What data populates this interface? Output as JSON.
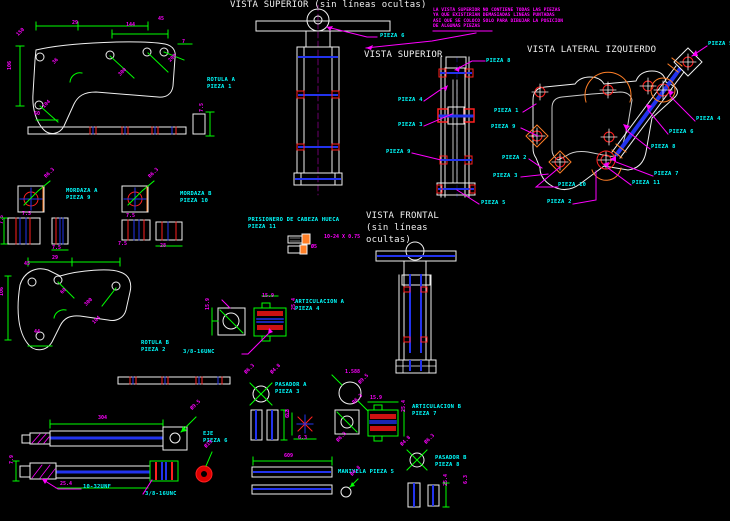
{
  "app": {
    "type": "cad-drawing-canvas",
    "background": "#000000"
  },
  "colors": {
    "white": "#f0f0f0",
    "green": "#00ff00",
    "magenta": "#ff00ff",
    "cyan": "#00ffff",
    "red": "#ff2020",
    "blue": "#2233ee",
    "orange": "#ff7f27"
  },
  "titles": [
    {
      "text": "VISTA SUPERIOR (sin líneas ocultas)",
      "x": 230,
      "y": 1
    },
    {
      "text": "VISTA SUPERIOR",
      "x": 364,
      "y": 51
    },
    {
      "text": "VISTA LATERAL IZQUIERDO",
      "x": 527,
      "y": 46
    },
    {
      "text": "VISTA FRONTAL",
      "x": 366,
      "y": 212
    },
    {
      "text": "(sin líneas",
      "x": 366,
      "y": 224
    },
    {
      "text": "ocultas)",
      "x": 366,
      "y": 236
    }
  ],
  "note": {
    "x": 433,
    "y": 9,
    "lines": [
      "LA VISTA SUPERIOR NO CONTIENE TODAS LAS PIEZAS",
      "YA QUE EXISTIRIAN DEMASIADAS LINEAS PUNTADAS",
      "ASI QUE SE COLOCO SOLO PARA DIBUJAR LA POSICION",
      "DE ALGUNAS PIEZAS"
    ]
  },
  "part_labels": [
    {
      "text": "PIEZA 6",
      "x": 380,
      "y": 34
    },
    {
      "text": "PIEZA 8",
      "x": 486,
      "y": 59
    },
    {
      "text": "PIEZA 4",
      "x": 398,
      "y": 98
    },
    {
      "text": "PIEZA 3",
      "x": 398,
      "y": 123
    },
    {
      "text": "PIEZA 9",
      "x": 386,
      "y": 150
    },
    {
      "text": "PIEZA 5",
      "x": 481,
      "y": 201
    },
    {
      "text": "PIEZA 1",
      "x": 494,
      "y": 109
    },
    {
      "text": "PIEZA 9",
      "x": 491,
      "y": 125
    },
    {
      "text": "PIEZA 2",
      "x": 502,
      "y": 156
    },
    {
      "text": "PIEZA 3",
      "x": 493,
      "y": 174
    },
    {
      "text": "PIEZA 5",
      "x": 708,
      "y": 42
    },
    {
      "text": "PIEZA 4",
      "x": 696,
      "y": 117
    },
    {
      "text": "PIEZA 6",
      "x": 669,
      "y": 130
    },
    {
      "text": "PIEZA 8",
      "x": 651,
      "y": 145
    },
    {
      "text": "PIEZA 7",
      "x": 654,
      "y": 172
    },
    {
      "text": "PIEZA 11",
      "x": 632,
      "y": 181
    },
    {
      "text": "PIEZA 10",
      "x": 558,
      "y": 183
    },
    {
      "text": "PIEZA 2",
      "x": 547,
      "y": 200
    },
    {
      "text": "ROTULA A",
      "x": 207,
      "y": 78
    },
    {
      "text": "PIEZA 1",
      "x": 207,
      "y": 85
    },
    {
      "text": "MORDAZA A",
      "x": 66,
      "y": 189
    },
    {
      "text": "PIEZA 9",
      "x": 66,
      "y": 196
    },
    {
      "text": "MORDAZA B",
      "x": 180,
      "y": 192
    },
    {
      "text": "PIEZA 10",
      "x": 180,
      "y": 199
    },
    {
      "text": "PRISIONERO DE CABEZA HUECA",
      "x": 248,
      "y": 218
    },
    {
      "text": "PIEZA 11",
      "x": 248,
      "y": 225
    },
    {
      "text": "ARTICULACION A",
      "x": 295,
      "y": 300
    },
    {
      "text": "PIEZA 4",
      "x": 295,
      "y": 307
    },
    {
      "text": "ROTULA B",
      "x": 141,
      "y": 341
    },
    {
      "text": "PIEZA 2",
      "x": 141,
      "y": 348
    },
    {
      "text": "3/8-16UNC",
      "x": 183,
      "y": 350
    },
    {
      "text": "EJE",
      "x": 203,
      "y": 432
    },
    {
      "text": "PIEZA 6",
      "x": 203,
      "y": 439
    },
    {
      "text": "10-32UNF",
      "x": 83,
      "y": 485
    },
    {
      "text": "3/8-16UNC",
      "x": 145,
      "y": 492
    },
    {
      "text": "PASADOR A",
      "x": 275,
      "y": 383
    },
    {
      "text": "PIEZA 3",
      "x": 275,
      "y": 390
    },
    {
      "text": "ARTICULACION B",
      "x": 412,
      "y": 405
    },
    {
      "text": "PIEZA 7",
      "x": 412,
      "y": 412
    },
    {
      "text": "MANIVELA PIEZA 5",
      "x": 338,
      "y": 470
    },
    {
      "text": "PASADOR B",
      "x": 435,
      "y": 456
    },
    {
      "text": "PIEZA 8",
      "x": 435,
      "y": 463
    }
  ],
  "dim_labels": [
    {
      "text": "29",
      "x": 72,
      "y": 21
    },
    {
      "text": "144",
      "x": 126,
      "y": 23
    },
    {
      "text": "45",
      "x": 158,
      "y": 17
    },
    {
      "text": "150",
      "x": 16,
      "y": 34,
      "rot": -45
    },
    {
      "text": "7",
      "x": 182,
      "y": 40
    },
    {
      "text": "36",
      "x": 52,
      "y": 62,
      "rot": -45
    },
    {
      "text": "200",
      "x": 168,
      "y": 60,
      "rot": -45
    },
    {
      "text": "106",
      "x": 8,
      "y": 70,
      "rot": -90
    },
    {
      "text": "300",
      "x": 118,
      "y": 74,
      "rot": -45
    },
    {
      "text": "104",
      "x": 42,
      "y": 106,
      "rot": -45
    },
    {
      "text": "60",
      "x": 34,
      "y": 112
    },
    {
      "text": "7.5",
      "x": 200,
      "y": 112,
      "rot": -90
    },
    {
      "text": "R6.3",
      "x": 44,
      "y": 176,
      "rot": -45
    },
    {
      "text": "7.5",
      "x": 22,
      "y": 212
    },
    {
      "text": "7.5",
      "x": 0,
      "y": 224,
      "rot": -90
    },
    {
      "text": "7.5",
      "x": 52,
      "y": 246
    },
    {
      "text": "R6.3",
      "x": 148,
      "y": 176,
      "rot": -45
    },
    {
      "text": "7.5",
      "x": 126,
      "y": 214
    },
    {
      "text": "7.5",
      "x": 118,
      "y": 242
    },
    {
      "text": "28",
      "x": 160,
      "y": 244
    },
    {
      "text": "10-24 X 0.75",
      "x": 324,
      "y": 235
    },
    {
      "text": "Ø5",
      "x": 311,
      "y": 245
    },
    {
      "text": "15.9",
      "x": 206,
      "y": 310,
      "rot": -90
    },
    {
      "text": "15.9",
      "x": 262,
      "y": 294
    },
    {
      "text": "25.4",
      "x": 292,
      "y": 310,
      "rot": -90
    },
    {
      "text": "29",
      "x": 52,
      "y": 256
    },
    {
      "text": "45",
      "x": 24,
      "y": 262
    },
    {
      "text": "106",
      "x": 0,
      "y": 296,
      "rot": -90
    },
    {
      "text": "60",
      "x": 60,
      "y": 292,
      "rot": -45
    },
    {
      "text": "300",
      "x": 84,
      "y": 304,
      "rot": -45
    },
    {
      "text": "104",
      "x": 92,
      "y": 322,
      "rot": -45
    },
    {
      "text": "44",
      "x": 34,
      "y": 330
    },
    {
      "text": "304",
      "x": 98,
      "y": 416
    },
    {
      "text": "Ø9.5",
      "x": 190,
      "y": 408,
      "rot": -45
    },
    {
      "text": "Ø19",
      "x": 204,
      "y": 446,
      "rot": -45
    },
    {
      "text": "7.9",
      "x": 10,
      "y": 464,
      "rot": -90
    },
    {
      "text": "25.4",
      "x": 60,
      "y": 482
    },
    {
      "text": "Ø6.3",
      "x": 244,
      "y": 372,
      "rot": -45
    },
    {
      "text": "Ø4.8",
      "x": 270,
      "y": 372,
      "rot": -45
    },
    {
      "text": "32",
      "x": 286,
      "y": 416,
      "rot": -90
    },
    {
      "text": "1.588",
      "x": 345,
      "y": 370
    },
    {
      "text": "Ø9.5",
      "x": 358,
      "y": 382,
      "rot": -45
    },
    {
      "text": "6.3",
      "x": 286,
      "y": 418,
      "rot": -90
    },
    {
      "text": "6.3",
      "x": 298,
      "y": 436
    },
    {
      "text": "15.9",
      "x": 370,
      "y": 396
    },
    {
      "text": "R6.3",
      "x": 352,
      "y": 402,
      "rot": -45
    },
    {
      "text": "25.4",
      "x": 402,
      "y": 412,
      "rot": -90
    },
    {
      "text": "Ø6.3",
      "x": 336,
      "y": 440,
      "rot": -45
    },
    {
      "text": "609",
      "x": 284,
      "y": 454
    },
    {
      "text": "Ø4.8",
      "x": 350,
      "y": 474,
      "rot": -45
    },
    {
      "text": "Ø4.8",
      "x": 400,
      "y": 444,
      "rot": -45
    },
    {
      "text": "Ø6.3",
      "x": 424,
      "y": 442,
      "rot": -45
    },
    {
      "text": "25.4",
      "x": 444,
      "y": 486,
      "rot": -90
    },
    {
      "text": "6.3",
      "x": 464,
      "y": 484,
      "rot": -90
    }
  ]
}
